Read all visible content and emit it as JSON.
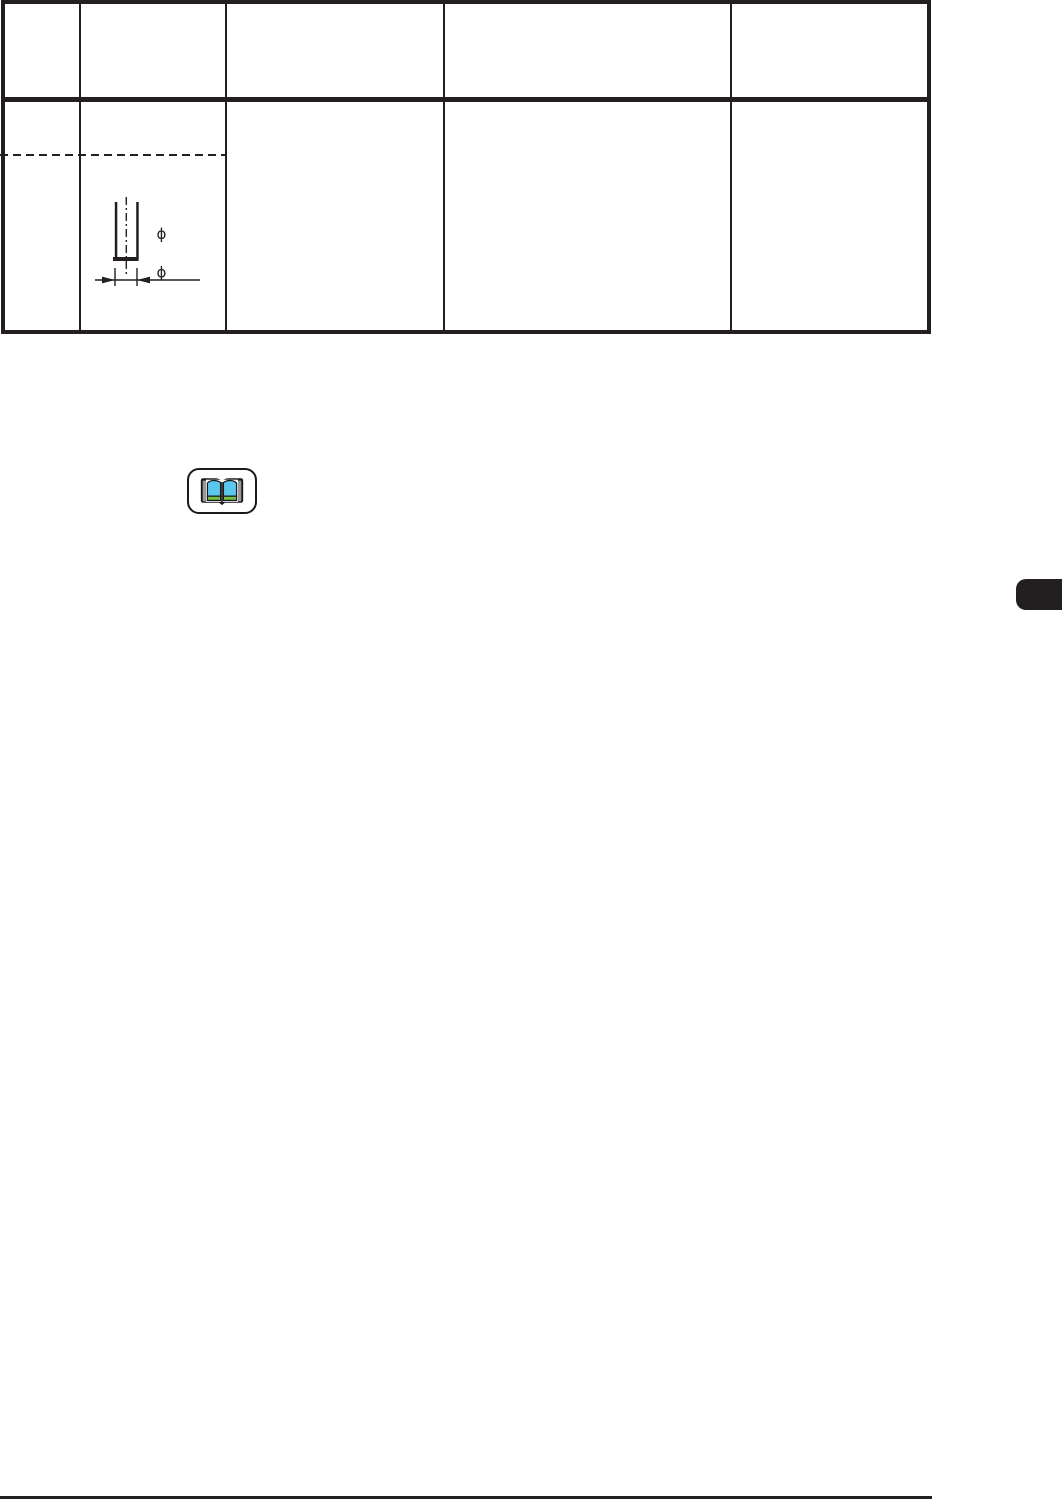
{
  "page": {
    "background_color": "#ffffff",
    "ink_color": "#231f20"
  },
  "table": {
    "column_count": 5,
    "row_count": 2,
    "header_cells": [
      "",
      "",
      "",
      "",
      ""
    ],
    "body_cells": [
      "",
      "",
      "",
      "",
      ""
    ]
  },
  "diagram": {
    "name": "needle-width-diagram",
    "inner_diameter_symbol": "ϕ",
    "outer_diameter_symbol": "ϕ"
  },
  "manual_icon": {
    "name": "open-book-icon",
    "page_color": "#5bc6ee",
    "base_color": "#76c043",
    "edge_color": "#97999c",
    "outline_color": "#1a1a1a"
  },
  "side_tab": {
    "color": "#231f20",
    "label": ""
  },
  "footer": {
    "rule_color": "#231f20"
  }
}
